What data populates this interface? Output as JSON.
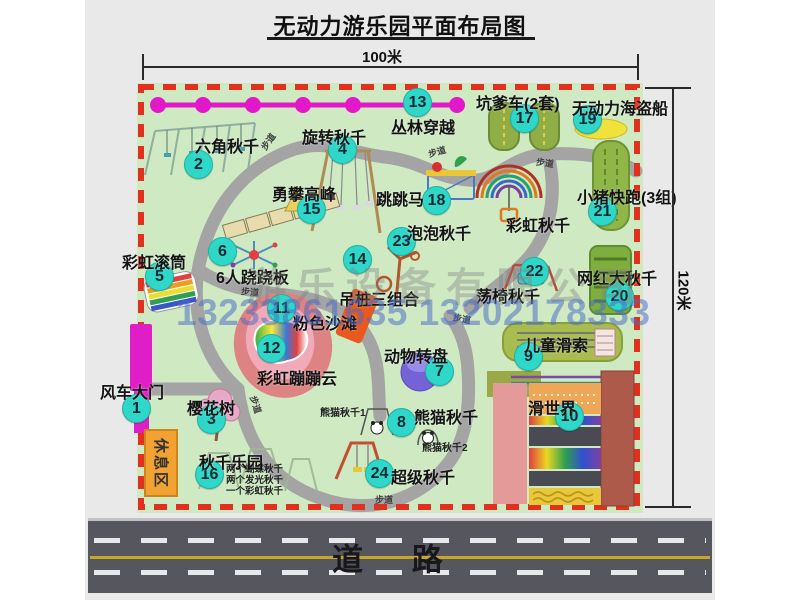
{
  "title": "无动力游乐园平面布局图",
  "top_dimension": "100米",
  "right_dimension": "120米",
  "road": {
    "label": "道 路"
  },
  "watermark": {
    "company": "游乐设备有限公司",
    "phones": "13233861635 13202178333"
  },
  "rest_area": {
    "label": "休息区"
  },
  "colors": {
    "map_green": "#cfe9c3",
    "border_red": "#e2301e",
    "marker_cyan": "#2fd7c9",
    "gate_magenta": "#e01ec8",
    "road_gray": "#56565e",
    "rest_orange": "#f2a232"
  },
  "markers": [
    {
      "num": "1",
      "label": "风车大门",
      "cx": 137,
      "cy": 409,
      "lx": 100,
      "ly": 379
    },
    {
      "num": "2",
      "label": "六角秋千",
      "cx": 199,
      "cy": 165,
      "lx": 195,
      "ly": 133
    },
    {
      "num": "3",
      "label": "樱花树",
      "cx": 212,
      "cy": 420,
      "lx": 187,
      "ly": 395
    },
    {
      "num": "4",
      "label": "旋转秋千",
      "cx": 343,
      "cy": 150,
      "lx": 302,
      "ly": 124
    },
    {
      "num": "5",
      "label": "彩虹滚筒",
      "cx": 160,
      "cy": 277,
      "lx": 122,
      "ly": 249
    },
    {
      "num": "6",
      "label": "6人跷跷板",
      "cx": 223,
      "cy": 252,
      "lx": 216,
      "ly": 264
    },
    {
      "num": "7",
      "label": "动物转盘",
      "cx": 440,
      "cy": 372,
      "lx": 384,
      "ly": 343
    },
    {
      "num": "8",
      "label": "熊猫秋千",
      "cx": 402,
      "cy": 423,
      "lx": 414,
      "ly": 404
    },
    {
      "num": "9",
      "label": "儿童滑索",
      "cx": 529,
      "cy": 357,
      "lx": 524,
      "ly": 332
    },
    {
      "num": "10",
      "label": "滑世界",
      "cx": 570,
      "cy": 417,
      "lx": 528,
      "ly": 395
    },
    {
      "num": "11",
      "label": "粉色沙滩",
      "cx": 282,
      "cy": 309,
      "lx": 293,
      "ly": 310
    },
    {
      "num": "12",
      "label": "彩虹蹦蹦云",
      "cx": 272,
      "cy": 349,
      "lx": 257,
      "ly": 365
    },
    {
      "num": "13",
      "label": "丛林穿越",
      "cx": 418,
      "cy": 103,
      "lx": 391,
      "ly": 114
    },
    {
      "num": "14",
      "label": "吊桩三组合",
      "cx": 358,
      "cy": 260,
      "lx": 339,
      "ly": 286
    },
    {
      "num": "15",
      "label": "勇攀高峰",
      "cx": 312,
      "cy": 210,
      "lx": 272,
      "ly": 181
    },
    {
      "num": "16",
      "label": "秋千乐园",
      "cx": 210,
      "cy": 475,
      "lx": 199,
      "ly": 449
    },
    {
      "num": "17",
      "label": "坑爹车(2套)",
      "cx": 525,
      "cy": 119,
      "lx": 476,
      "ly": 90
    },
    {
      "num": "18",
      "label": "跳跳马",
      "cx": 437,
      "cy": 201,
      "lx": 376,
      "ly": 186
    },
    {
      "num": "19",
      "label": "无动力海盗船",
      "cx": 588,
      "cy": 120,
      "lx": 572,
      "ly": 95
    },
    {
      "num": "20",
      "label": "网红大秋千",
      "cx": 620,
      "cy": 297,
      "lx": 577,
      "ly": 265
    },
    {
      "num": "21",
      "label": "小猪快跑(3组)",
      "cx": 603,
      "cy": 212,
      "lx": 577,
      "ly": 184
    },
    {
      "num": "22",
      "label": "荡椅秋千",
      "cx": 535,
      "cy": 272,
      "lx": 476,
      "ly": 283
    },
    {
      "num": "23",
      "label": "泡泡秋千",
      "cx": 402,
      "cy": 242,
      "lx": 407,
      "ly": 220
    },
    {
      "num": "24",
      "label": "超级秋千",
      "cx": 380,
      "cy": 474,
      "lx": 391,
      "ly": 464
    }
  ],
  "extra_labels": [
    {
      "name": "rainbow-swing-label",
      "text": "彩虹秋千",
      "x": 506,
      "y": 212,
      "cls": "big",
      "rot": 0
    },
    {
      "name": "panda-swing-1-label",
      "text": "熊猫秋千1",
      "x": 320,
      "y": 404,
      "cls": "tiny",
      "rot": 0
    },
    {
      "name": "panda-swing-2-label",
      "text": "熊猫秋千2",
      "x": 422,
      "y": 439,
      "cls": "tiny",
      "rot": 0
    },
    {
      "name": "path-label",
      "text": "步道",
      "x": 259,
      "y": 135,
      "cls": "path",
      "rot": -55
    },
    {
      "name": "path-label",
      "text": "步道",
      "x": 428,
      "y": 145,
      "cls": "path",
      "rot": -15
    },
    {
      "name": "path-label",
      "text": "步道",
      "x": 536,
      "y": 156,
      "cls": "path",
      "rot": 8
    },
    {
      "name": "path-label",
      "text": "步道",
      "x": 241,
      "y": 285,
      "cls": "path",
      "rot": 5
    },
    {
      "name": "path-label",
      "text": "步道",
      "x": 453,
      "y": 312,
      "cls": "path",
      "rot": 10
    },
    {
      "name": "path-label",
      "text": "步道",
      "x": 375,
      "y": 493,
      "cls": "path",
      "rot": 0
    },
    {
      "name": "path-label",
      "text": "步道",
      "x": 247,
      "y": 398,
      "cls": "path",
      "rot": 72
    }
  ],
  "swing_park_details": [
    "两个蝴蝶秋千",
    "两个发光秋千",
    "一个彩虹秋千"
  ]
}
